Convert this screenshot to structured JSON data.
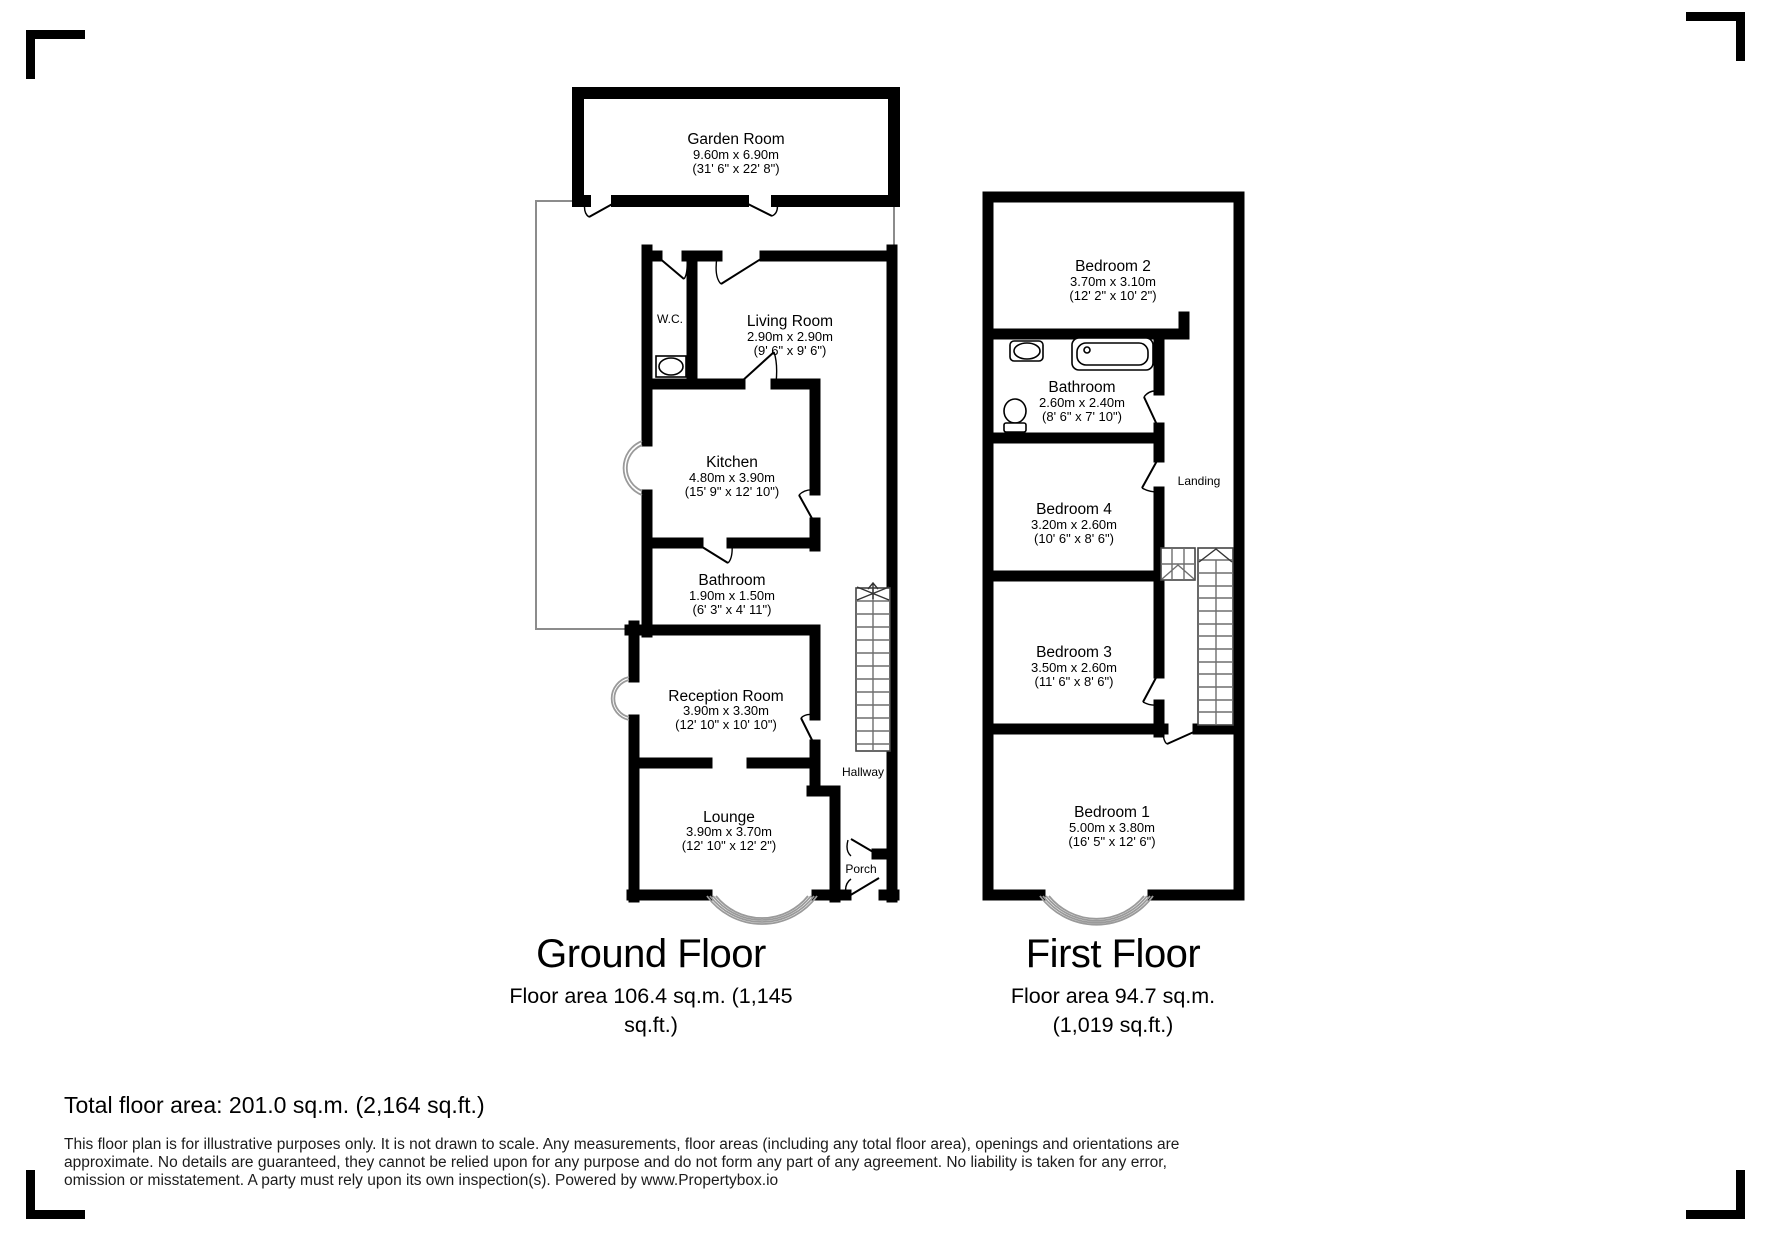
{
  "ground_floor": {
    "title": "Ground Floor",
    "area_line1": "Floor area 106.4 sq.m. (1,145",
    "area_line2": "sq.ft.)",
    "rooms": {
      "garden_room": {
        "name": "Garden Room",
        "metric": "9.60m x 6.90m",
        "imperial": "(31' 6\" x 22' 8\")"
      },
      "wc": {
        "name": "W.C."
      },
      "living_room": {
        "name": "Living Room",
        "metric": "2.90m x 2.90m",
        "imperial": "(9' 6\" x 9' 6\")"
      },
      "kitchen": {
        "name": "Kitchen",
        "metric": "4.80m x 3.90m",
        "imperial": "(15' 9\" x 12' 10\")"
      },
      "bathroom": {
        "name": "Bathroom",
        "metric": "1.90m x 1.50m",
        "imperial": "(6' 3\" x 4' 11\")"
      },
      "reception_room": {
        "name": "Reception Room",
        "metric": "3.90m x 3.30m",
        "imperial": "(12' 10\" x 10' 10\")"
      },
      "lounge": {
        "name": "Lounge",
        "metric": "3.90m x 3.70m",
        "imperial": "(12' 10\" x 12' 2\")"
      },
      "hallway": {
        "name": "Hallway"
      },
      "porch": {
        "name": "Porch"
      }
    }
  },
  "first_floor": {
    "title": "First Floor",
    "area_line1": "Floor area 94.7 sq.m.",
    "area_line2": "(1,019 sq.ft.)",
    "rooms": {
      "bedroom_2": {
        "name": "Bedroom 2",
        "metric": "3.70m x 3.10m",
        "imperial": "(12' 2\" x 10' 2\")"
      },
      "bathroom": {
        "name": "Bathroom",
        "metric": "2.60m x 2.40m",
        "imperial": "(8' 6\" x 7' 10\")"
      },
      "landing": {
        "name": "Landing"
      },
      "bedroom_4": {
        "name": "Bedroom 4",
        "metric": "3.20m x 2.60m",
        "imperial": "(10' 6\" x 8' 6\")"
      },
      "bedroom_3": {
        "name": "Bedroom 3",
        "metric": "3.50m x 2.60m",
        "imperial": "(11' 6\" x 8' 6\")"
      },
      "bedroom_1": {
        "name": "Bedroom 1",
        "metric": "5.00m x 3.80m",
        "imperial": "(16' 5\" x 12' 6\")"
      }
    }
  },
  "summary": {
    "total_area": "Total floor area: 201.0 sq.m. (2,164 sq.ft.)"
  },
  "disclaimer": {
    "line1": "This floor plan is for illustrative purposes only. It is not drawn to scale. Any measurements, floor areas (including any total floor area), openings and orientations are",
    "line2": "approximate. No details are guaranteed, they cannot be relied upon for any purpose and do not form any part of any agreement. No liability is taken for any error,",
    "line3": "omission or misstatement. A party must rely upon its own inspection(s). Powered by www.Propertybox.io"
  },
  "colors": {
    "wall": "#000000",
    "patio_outline": "#8c8c8c",
    "bay_window": "#9a9a9a",
    "stair_detail": "#6e6e6e",
    "disclaimer_text": "#1c1c1c"
  }
}
